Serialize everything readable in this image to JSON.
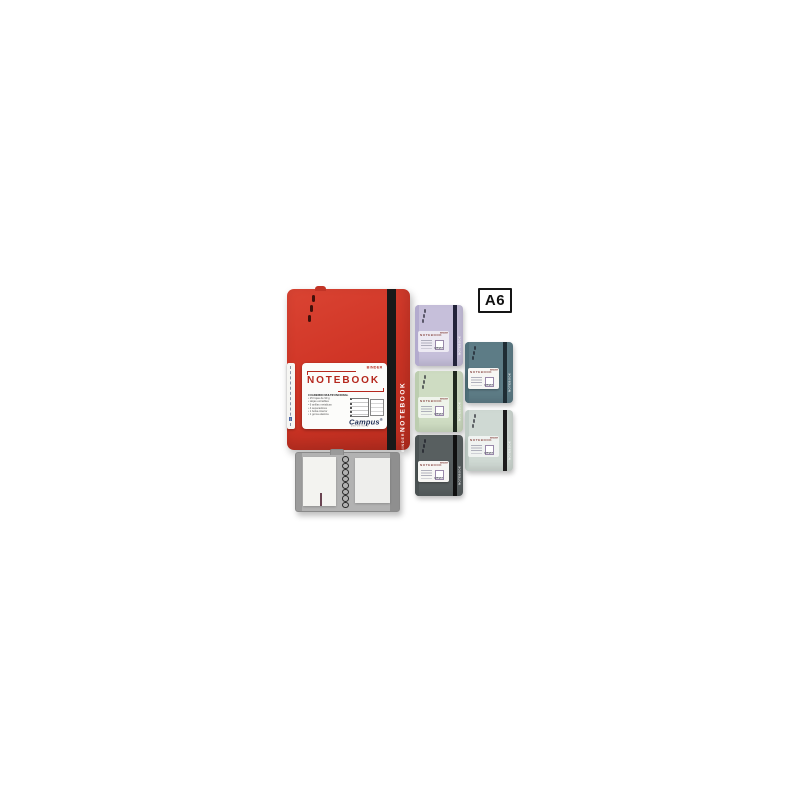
{
  "page": {
    "background_color": "#ffffff"
  },
  "size_badge": {
    "text": "A6"
  },
  "main_notebook": {
    "color_name": "red",
    "cover_color": "#d03526",
    "band_color": "#191919",
    "spine_subtitle": "BINDER",
    "spine_title": "NOTEBOOK",
    "label": {
      "binder_text": "BINDER",
      "title": "NOTEBOOK",
      "features_heading": "CUADERNO MULTIFUNCIONAL",
      "features": [
        "25 hojas de 90 g",
        "Hojas extraibles",
        "6 anillas metalicas",
        "4 separadores",
        "1 bolsa interior",
        "1 goma elastica"
      ],
      "brand": "Campus",
      "brand_sub": "university"
    }
  },
  "mini_label": {
    "binder_text": "BINDER",
    "title": "NOTEBOOK",
    "brand": "Campus"
  },
  "mini_notebooks": [
    {
      "name": "lavender",
      "cover_color": "#c6bfda",
      "band_color": "#23233a",
      "spine_color": "#b3abce",
      "label_variant": "faint"
    },
    {
      "name": "teal",
      "cover_color": "#5d7c86",
      "band_color": "#1f2d34",
      "spine_color": "#50707a",
      "label_variant": "solid"
    },
    {
      "name": "sage",
      "cover_color": "#cedcc2",
      "band_color": "#1f291f",
      "spine_color": "#bccdaf",
      "label_variant": "faint"
    },
    {
      "name": "mint",
      "cover_color": "#cfd9d3",
      "band_color": "#1c1c1c",
      "spine_color": "#bfccc5",
      "label_variant": "faint"
    },
    {
      "name": "charcoal",
      "cover_color": "#585f60",
      "band_color": "#101010",
      "spine_color": "#4b5253",
      "label_variant": "solid"
    }
  ],
  "open_binder": {
    "cover_color": "#b2b2b2",
    "page_color": "#f3f3f0",
    "rings_count": 8
  }
}
